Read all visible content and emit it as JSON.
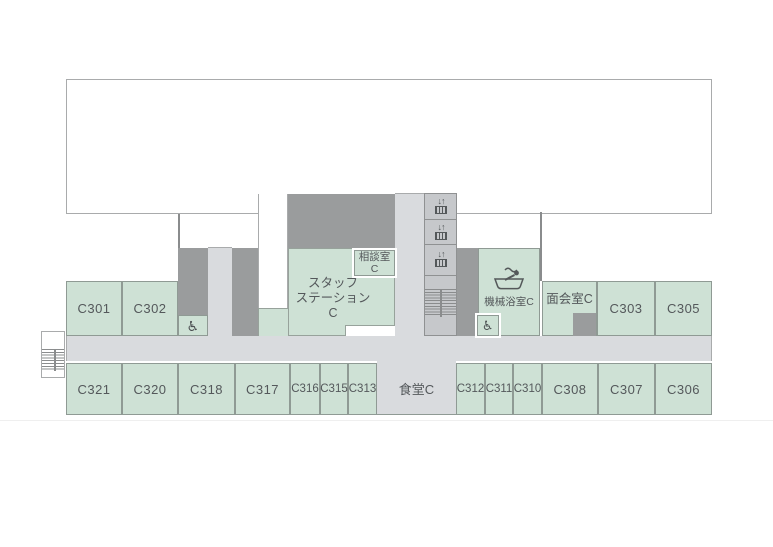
{
  "colors": {
    "room_green": "#cee1d5",
    "corridor_gray": "#d9dbde",
    "block_gray": "#9a9c9d",
    "elevator_gray": "#c6c8cb",
    "outline_gray": "#a9abac",
    "text_gray": "#54585b"
  },
  "rooms": {
    "upper": [
      {
        "label": "C301"
      },
      {
        "label": "C302"
      },
      {
        "label": "C303"
      },
      {
        "label": "C305"
      }
    ],
    "lower": [
      {
        "label": "C321"
      },
      {
        "label": "C320"
      },
      {
        "label": "C318"
      },
      {
        "label": "C317"
      },
      {
        "label": "C316"
      },
      {
        "label": "C315"
      },
      {
        "label": "C313"
      },
      {
        "label": "C312"
      },
      {
        "label": "C311"
      },
      {
        "label": "C310"
      },
      {
        "label": "C308"
      },
      {
        "label": "C307"
      },
      {
        "label": "C306"
      }
    ]
  },
  "facilities": {
    "staff_station": {
      "lines": [
        "スタッフ",
        "ステーション",
        "C"
      ]
    },
    "consult_room": {
      "lines": [
        "相談室",
        "C"
      ]
    },
    "machine_bath": {
      "label": "機械浴室C"
    },
    "meeting_room": {
      "label": "面会室C"
    },
    "dining_hall": {
      "label": "食堂C"
    }
  },
  "icons": {
    "elevator": {
      "arrows": "↓↑"
    },
    "wheelchair": {
      "glyph": "♿"
    }
  }
}
